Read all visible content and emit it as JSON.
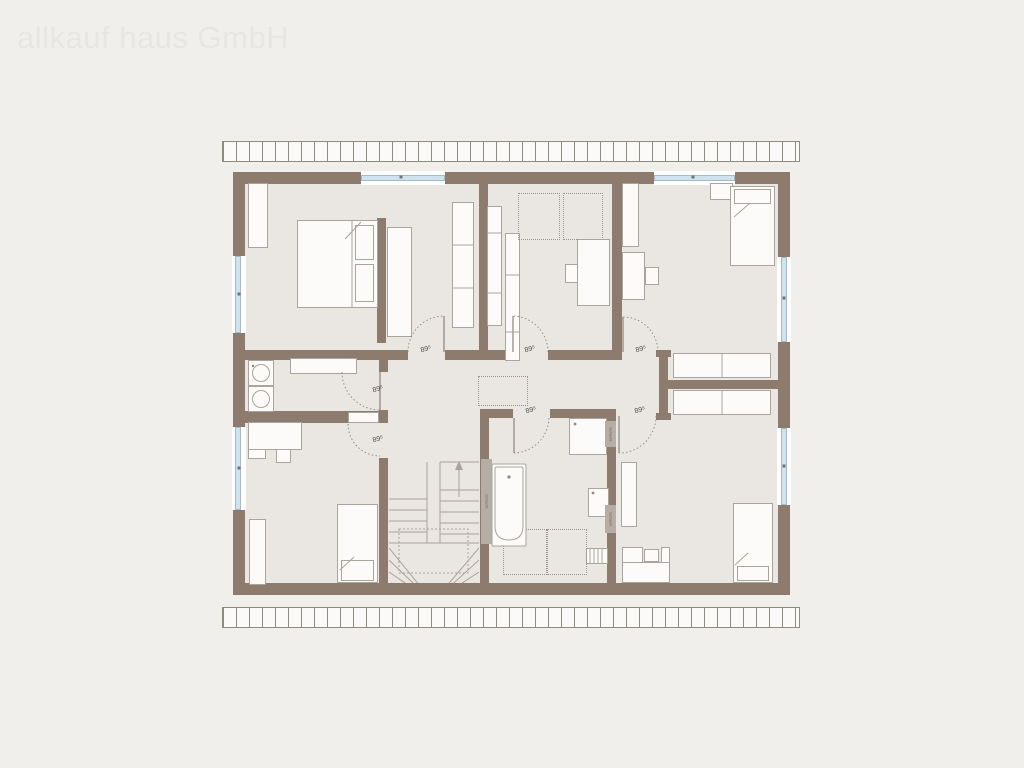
{
  "watermark": "allkauf haus GmbH",
  "plan": {
    "type": "floor-plan-upper-storey",
    "doors": [
      {
        "id": "master-bedroom-door",
        "label": "89⁵"
      },
      {
        "id": "child-room-1-door",
        "label": "89⁵"
      },
      {
        "id": "child-room-2-door",
        "label": "89⁵"
      },
      {
        "id": "utility-room-door",
        "label": "89⁵"
      },
      {
        "id": "child-room-3-door",
        "label": "89⁵"
      },
      {
        "id": "bathroom-door",
        "label": "89⁵"
      },
      {
        "id": "child-room-4-door",
        "label": "89⁵"
      }
    ],
    "shafts": [
      {
        "label": "Schacht"
      },
      {
        "label": "Schacht"
      },
      {
        "label": "Schacht"
      }
    ],
    "colors": {
      "background": "#f0efec",
      "wall": "#8d7c6d",
      "floor": "#eae7e2",
      "window_glass": "#cfe3ee",
      "furniture_outline": "#a9a49c",
      "shaft_strip": "#b6aea4",
      "watermark": "#e7e6e2"
    },
    "furniture_icons": [
      "double-bed",
      "single-bed",
      "wardrobe",
      "shelf",
      "desk",
      "chair",
      "washing-machine",
      "dryer",
      "counter",
      "bathtub",
      "shower",
      "washbasin",
      "radiator",
      "winder-stairs",
      "dashed-planned-furniture",
      "closet",
      "nightstand"
    ]
  }
}
